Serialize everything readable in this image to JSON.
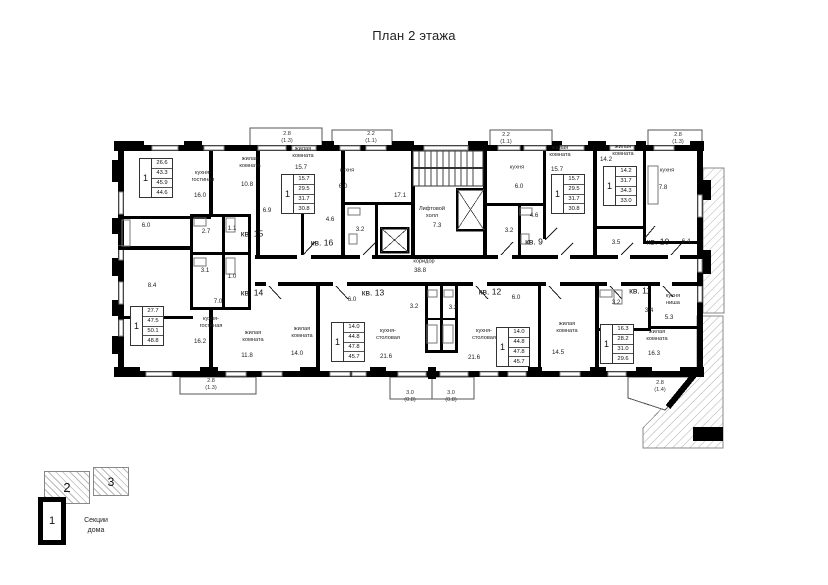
{
  "title": "План 2 этажа",
  "legend": {
    "caption": "Секции\nдома",
    "sections": [
      {
        "label": "1"
      },
      {
        "label": "2"
      },
      {
        "label": "3"
      }
    ]
  },
  "plan": {
    "labels": [
      {
        "t": "кв. 15",
        "x": 252,
        "y": 234,
        "k": "apt"
      },
      {
        "t": "кв. 16",
        "x": 322,
        "y": 243,
        "k": "apt"
      },
      {
        "t": "кв. 9",
        "x": 534,
        "y": 242,
        "k": "apt"
      },
      {
        "t": "кв. 10",
        "x": 658,
        "y": 242,
        "k": "apt"
      },
      {
        "t": "кв. 14",
        "x": 252,
        "y": 293,
        "k": "apt"
      },
      {
        "t": "кв. 13",
        "x": 373,
        "y": 293,
        "k": "apt"
      },
      {
        "t": "кв. 12",
        "x": 490,
        "y": 292,
        "k": "apt"
      },
      {
        "t": "кв. 11",
        "x": 640,
        "y": 291,
        "k": "apt"
      },
      {
        "t": "кухня-\nгостиная",
        "x": 203,
        "y": 177,
        "k": "room"
      },
      {
        "t": "16.0",
        "x": 200,
        "y": 196,
        "k": "area"
      },
      {
        "t": "жилая\nкомната",
        "x": 250,
        "y": 163,
        "k": "room"
      },
      {
        "t": "10.8",
        "x": 247,
        "y": 185,
        "k": "area"
      },
      {
        "t": "6.9",
        "x": 267,
        "y": 211,
        "k": "area"
      },
      {
        "t": "6.0",
        "x": 146,
        "y": 226,
        "k": "area"
      },
      {
        "t": "2.7",
        "x": 206,
        "y": 232,
        "k": "area"
      },
      {
        "t": "1.1",
        "x": 232,
        "y": 229,
        "k": "area"
      },
      {
        "t": "8.4",
        "x": 152,
        "y": 286,
        "k": "area"
      },
      {
        "t": "3.1",
        "x": 205,
        "y": 271,
        "k": "area"
      },
      {
        "t": "1.0",
        "x": 232,
        "y": 277,
        "k": "area"
      },
      {
        "t": "7.0",
        "x": 218,
        "y": 302,
        "k": "area"
      },
      {
        "t": "кухня-\nгостиная",
        "x": 211,
        "y": 323,
        "k": "room"
      },
      {
        "t": "16.2",
        "x": 200,
        "y": 342,
        "k": "area"
      },
      {
        "t": "жилая\nкомната",
        "x": 253,
        "y": 337,
        "k": "room"
      },
      {
        "t": "11.8",
        "x": 247,
        "y": 356,
        "k": "area"
      },
      {
        "t": "жилая\nкомната",
        "x": 303,
        "y": 153,
        "k": "room"
      },
      {
        "t": "15.7",
        "x": 301,
        "y": 168,
        "k": "area"
      },
      {
        "t": "кухня",
        "x": 347,
        "y": 171,
        "k": "room"
      },
      {
        "t": "6.0",
        "x": 343,
        "y": 187,
        "k": "area"
      },
      {
        "t": "4.6",
        "x": 330,
        "y": 220,
        "k": "area"
      },
      {
        "t": "3.2",
        "x": 360,
        "y": 230,
        "k": "area"
      },
      {
        "t": "17.1",
        "x": 400,
        "y": 196,
        "k": "area"
      },
      {
        "t": "Лифтовой\nхолл",
        "x": 432,
        "y": 213,
        "k": "room"
      },
      {
        "t": "7.3",
        "x": 437,
        "y": 226,
        "k": "area"
      },
      {
        "t": "коридор",
        "x": 424,
        "y": 262,
        "k": "room"
      },
      {
        "t": "38.8",
        "x": 420,
        "y": 271,
        "k": "area"
      },
      {
        "t": "кухня",
        "x": 517,
        "y": 168,
        "k": "room"
      },
      {
        "t": "6.0",
        "x": 519,
        "y": 187,
        "k": "area"
      },
      {
        "t": "жилая\nкомната",
        "x": 560,
        "y": 152,
        "k": "room"
      },
      {
        "t": "15.7",
        "x": 557,
        "y": 170,
        "k": "area"
      },
      {
        "t": "4.6",
        "x": 534,
        "y": 216,
        "k": "area"
      },
      {
        "t": "3.2",
        "x": 509,
        "y": 231,
        "k": "area"
      },
      {
        "t": "14.2",
        "x": 606,
        "y": 160,
        "k": "area"
      },
      {
        "t": "жилая\nкомната",
        "x": 623,
        "y": 151,
        "k": "room"
      },
      {
        "t": "кухня",
        "x": 667,
        "y": 171,
        "k": "room"
      },
      {
        "t": "7.8",
        "x": 663,
        "y": 188,
        "k": "area"
      },
      {
        "t": "3.5",
        "x": 616,
        "y": 243,
        "k": "area"
      },
      {
        "t": "6.4",
        "x": 686,
        "y": 242,
        "k": "area"
      },
      {
        "t": "жилая\nкомната",
        "x": 302,
        "y": 333,
        "k": "room"
      },
      {
        "t": "14.0",
        "x": 297,
        "y": 354,
        "k": "area"
      },
      {
        "t": "кухня-\nстоловая",
        "x": 388,
        "y": 335,
        "k": "room"
      },
      {
        "t": "21.6",
        "x": 386,
        "y": 357,
        "k": "area"
      },
      {
        "t": "6.0",
        "x": 352,
        "y": 300,
        "k": "area"
      },
      {
        "t": "3.2",
        "x": 414,
        "y": 307,
        "k": "area"
      },
      {
        "t": "кухня-\nстоловая",
        "x": 484,
        "y": 335,
        "k": "room"
      },
      {
        "t": "21.6",
        "x": 474,
        "y": 358,
        "k": "area"
      },
      {
        "t": "6.0",
        "x": 516,
        "y": 298,
        "k": "area"
      },
      {
        "t": "3.2",
        "x": 453,
        "y": 308,
        "k": "area"
      },
      {
        "t": "жилая\nкомната",
        "x": 567,
        "y": 328,
        "k": "room"
      },
      {
        "t": "14.5",
        "x": 558,
        "y": 353,
        "k": "area"
      },
      {
        "t": "3.2",
        "x": 616,
        "y": 303,
        "k": "area"
      },
      {
        "t": "3.4",
        "x": 649,
        "y": 311,
        "k": "area"
      },
      {
        "t": "кухня\nниша",
        "x": 673,
        "y": 300,
        "k": "room"
      },
      {
        "t": "5.3",
        "x": 669,
        "y": 318,
        "k": "area"
      },
      {
        "t": "жилая\nкомната",
        "x": 657,
        "y": 336,
        "k": "room"
      },
      {
        "t": "16.3",
        "x": 654,
        "y": 354,
        "k": "area"
      },
      {
        "t": "2.8\n(1.3)",
        "x": 287,
        "y": 138,
        "k": "balc"
      },
      {
        "t": "2.2\n(1.1)",
        "x": 371,
        "y": 138,
        "k": "balc"
      },
      {
        "t": "2.2\n(1.1)",
        "x": 506,
        "y": 139,
        "k": "balc"
      },
      {
        "t": "2.8\n(1.3)",
        "x": 678,
        "y": 139,
        "k": "balc"
      },
      {
        "t": "2.8\n(1.3)",
        "x": 211,
        "y": 385,
        "k": "balc"
      },
      {
        "t": "3.0\n(0.8)",
        "x": 410,
        "y": 397,
        "k": "balc"
      },
      {
        "t": "3.0\n(0.8)",
        "x": 451,
        "y": 397,
        "k": "balc"
      },
      {
        "t": "2.8\n(1.4)",
        "x": 660,
        "y": 387,
        "k": "balc"
      }
    ],
    "info_blocks": [
      {
        "apt": "15",
        "x": 139,
        "y": 158,
        "rooms": "1",
        "values": [
          "26.6",
          "43.3",
          "45.9",
          "44.6"
        ]
      },
      {
        "apt": "16",
        "x": 281,
        "y": 174,
        "rooms": "1",
        "values": [
          "15.7",
          "29.5",
          "31.7",
          "30.8"
        ]
      },
      {
        "apt": "9",
        "x": 551,
        "y": 174,
        "rooms": "1",
        "values": [
          "15.7",
          "29.5",
          "31.7",
          "30.8"
        ]
      },
      {
        "apt": "10",
        "x": 603,
        "y": 166,
        "rooms": "1",
        "values": [
          "14.2",
          "31.7",
          "34.3",
          "33.0"
        ]
      },
      {
        "apt": "14",
        "x": 130,
        "y": 306,
        "rooms": "1",
        "values": [
          "27.7",
          "47.5",
          "50.1",
          "48.8"
        ]
      },
      {
        "apt": "13",
        "x": 331,
        "y": 322,
        "rooms": "1",
        "values": [
          "14.0",
          "44.8",
          "47.8",
          "45.7"
        ]
      },
      {
        "apt": "12",
        "x": 496,
        "y": 327,
        "rooms": "1",
        "values": [
          "14.0",
          "44.8",
          "47.8",
          "45.7"
        ]
      },
      {
        "apt": "11",
        "x": 600,
        "y": 324,
        "rooms": "1",
        "values": [
          "16.3",
          "28.2",
          "31.0",
          "29.6"
        ]
      }
    ]
  }
}
